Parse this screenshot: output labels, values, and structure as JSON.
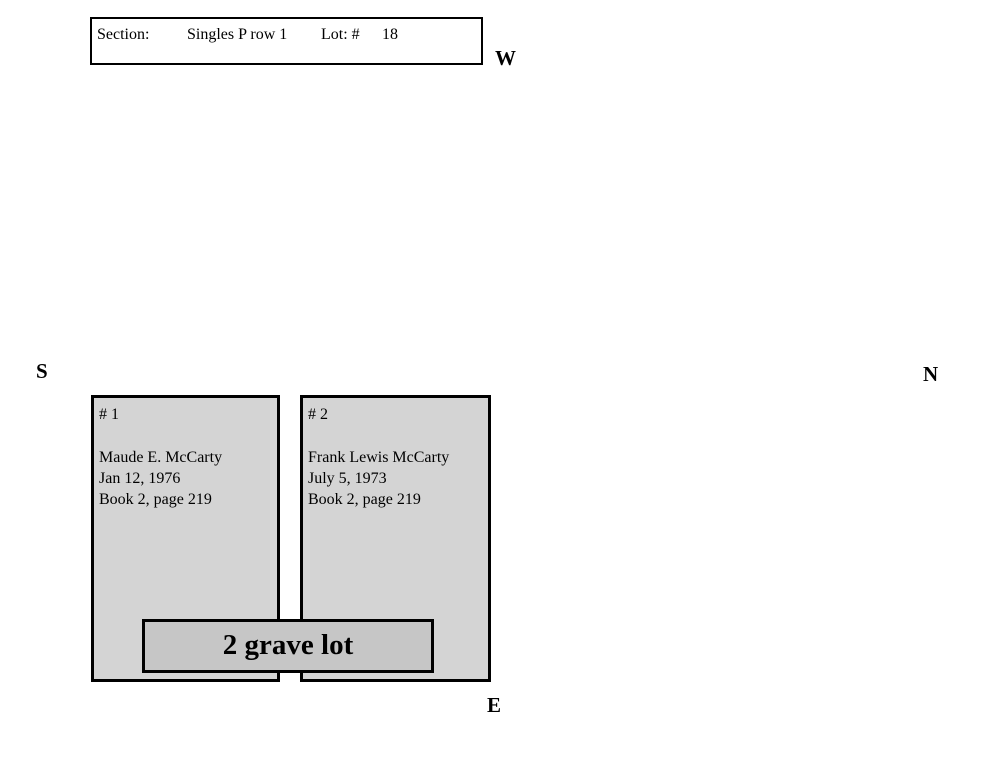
{
  "header": {
    "section_label": "Section:",
    "section_value": "Singles P row 1",
    "lot_label": "Lot: #",
    "lot_number": "18"
  },
  "compass": {
    "west": "W",
    "south": "S",
    "north": "N",
    "east": "E"
  },
  "graves": [
    {
      "number": "# 1",
      "name": "Maude E. McCarty",
      "death_date": "Jan 12, 1976",
      "record": "Book 2, page 219"
    },
    {
      "number": "# 2",
      "name": "Frank Lewis McCarty",
      "death_date": "July 5, 1973",
      "record": "Book 2, page 219"
    }
  ],
  "banner": {
    "label": "2 grave lot"
  },
  "colors": {
    "grave_fill": "#d4d4d4",
    "banner_fill": "#c6c6c6",
    "border": "#000000",
    "background": "#ffffff",
    "text": "#000000"
  }
}
